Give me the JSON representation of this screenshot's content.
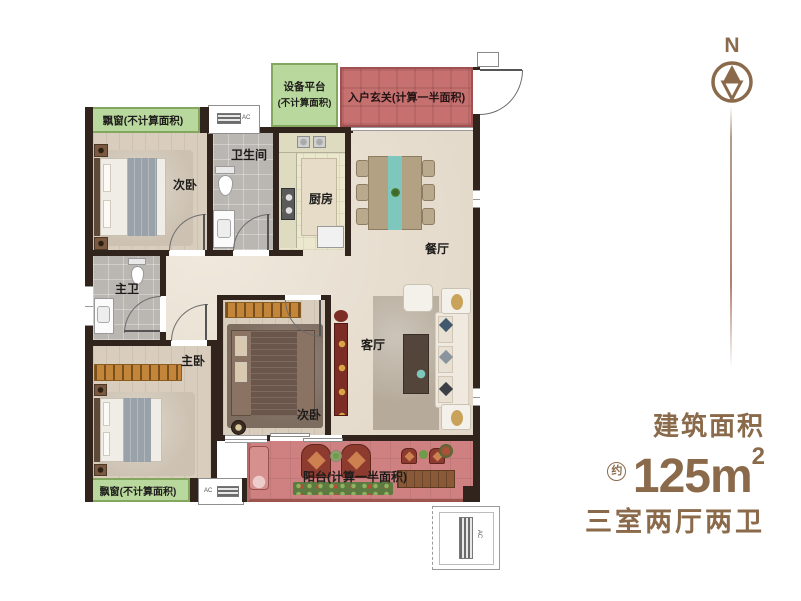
{
  "compass": {
    "label": "N"
  },
  "info": {
    "area_title": "建筑面积",
    "approx_badge": "约",
    "area_number": "125m",
    "area_exponent": "2",
    "layout_summary": "三室两厅两卫"
  },
  "plan": {
    "labels": {
      "bay_window_top": "飘窗(不计算面积)",
      "equipment_platform_l1": "设备平台",
      "equipment_platform_l2": "(不计算面积)",
      "entry_foyer": "入户玄关(计算一半面积)",
      "bedroom_top": "次卧",
      "bathroom": "卫生间",
      "kitchen": "厨房",
      "dining": "餐厅",
      "master_bath": "主卫",
      "master_bedroom": "主卧",
      "bedroom_center": "次卧",
      "living": "客厅",
      "balcony": "阳台(计算一半面积)",
      "bay_window_bottom": "飘窗(不计算面积)",
      "ac_unit": "AC"
    }
  },
  "colors": {
    "accent_brown": "#8a6a4a",
    "overlay_green": "#b9d89e",
    "overlay_red": "#c77070",
    "balcony_pink": "#cf8181",
    "wall": "#31241c"
  }
}
